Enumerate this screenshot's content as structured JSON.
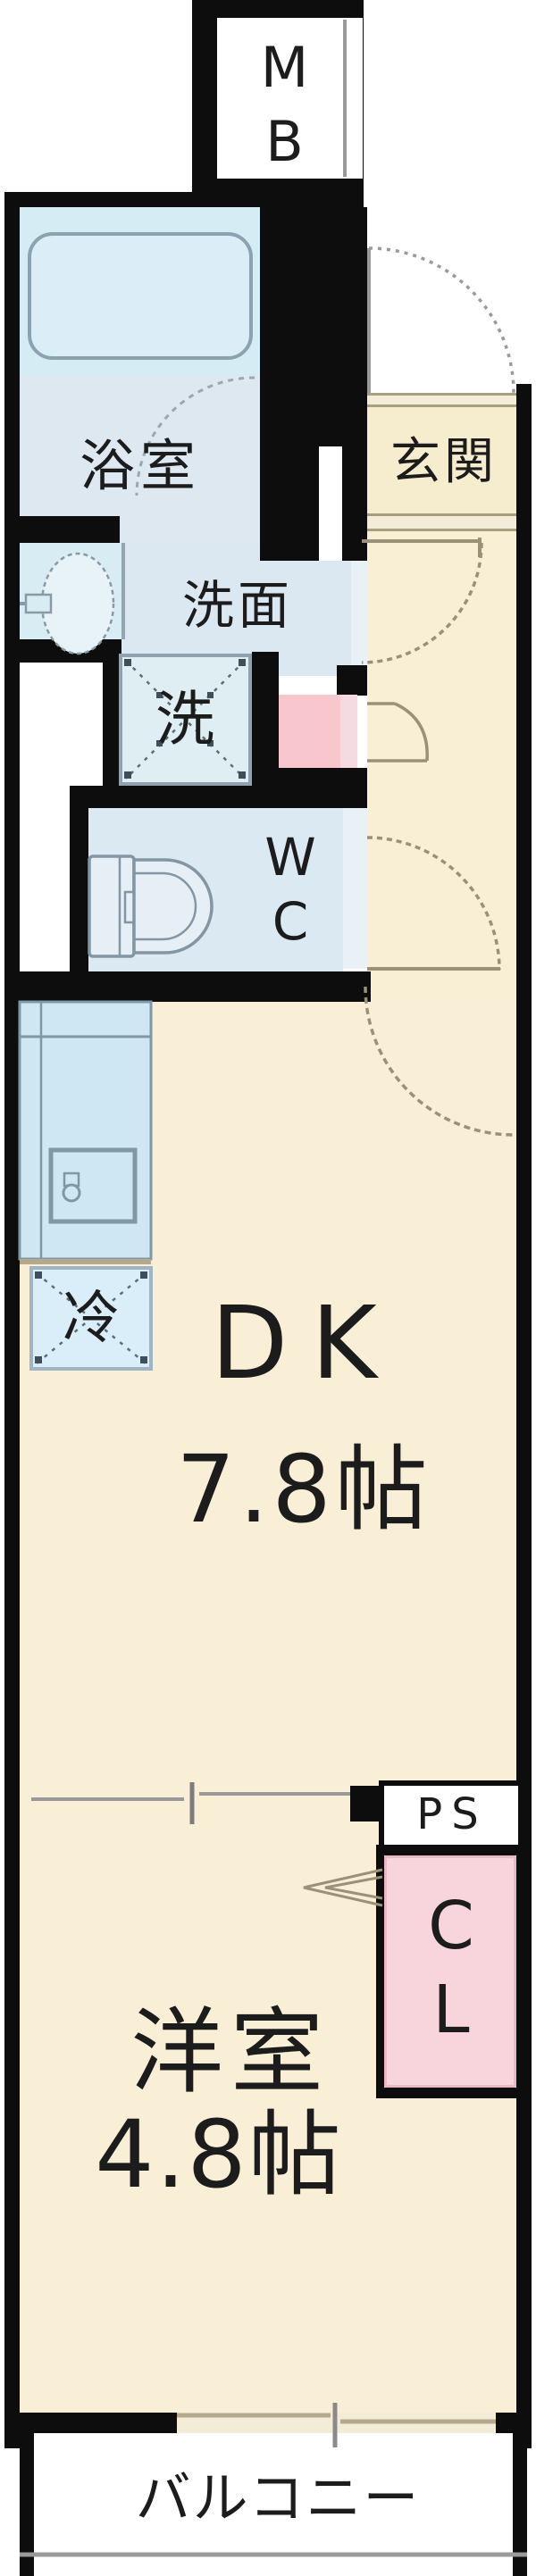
{
  "plan": {
    "type": "apartment-floor-plan",
    "rooms": {
      "meter_box": {
        "label": "MB"
      },
      "bathroom": {
        "label": "浴室"
      },
      "entrance": {
        "label": "玄関"
      },
      "washroom": {
        "label": "洗面"
      },
      "washer": {
        "label": "洗"
      },
      "toilet": {
        "label": "WC"
      },
      "refrigerator": {
        "label": "冷"
      },
      "dining_kitchen": {
        "label": "DK",
        "size": "7.8帖"
      },
      "pipe_space": {
        "label": "PS"
      },
      "closet": {
        "label": "CL"
      },
      "western_room": {
        "label": "洋室",
        "size": "4.8帖"
      },
      "balcony": {
        "label": "バルコニー"
      }
    },
    "colors": {
      "wall": "#0d0d0d",
      "floor_cream": "#f8efd5",
      "room_blue": "#dce8f1",
      "bath_cyan": "#d5ecf4",
      "counter_blue": "#cfe7f3",
      "fixture_cyan": "#dfeef3",
      "shoe_box_pink": "#f8c7ce",
      "closet_pink": "#f8d5dc",
      "door_tan": "#9b9178",
      "arc_gray": "#9a9a9a",
      "outline_blue_gray": "#7e98a6"
    }
  }
}
